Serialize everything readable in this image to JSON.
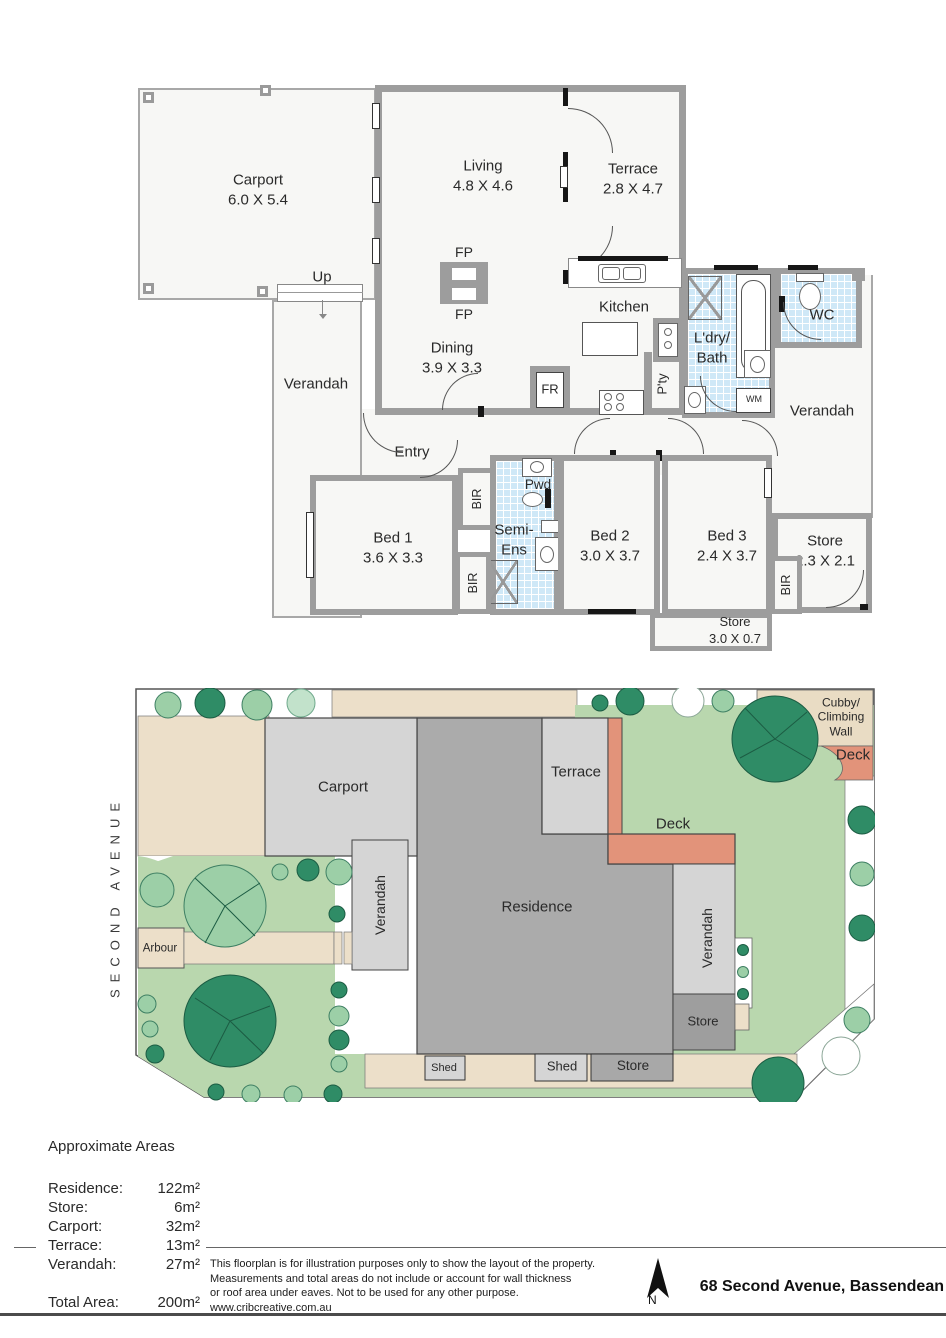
{
  "floorplan": {
    "rooms": {
      "carport": {
        "name": "Carport",
        "dims": "6.0 X 5.4"
      },
      "living": {
        "name": "Living",
        "dims": "4.8 X 4.6"
      },
      "terrace": {
        "name": "Terrace",
        "dims": "2.8 X 4.7"
      },
      "dining": {
        "name": "Dining",
        "dims": "3.9 X 3.3"
      },
      "kitchen": {
        "name": "Kitchen"
      },
      "bed1": {
        "name": "Bed 1",
        "dims": "3.6 X 3.3"
      },
      "bed2": {
        "name": "Bed 2",
        "dims": "3.0 X 3.7"
      },
      "bed3": {
        "name": "Bed 3",
        "dims": "2.4 X 3.7"
      },
      "store_right": {
        "name": "Store",
        "dims": "2.3 X 2.1"
      },
      "store_bottom": {
        "name": "Store",
        "dims": "3.0 X 0.7"
      },
      "laundry_bath": {
        "line1": "L'dry/",
        "line2": "Bath"
      },
      "semi_ens": {
        "line1": "Semi-",
        "line2": "Ens"
      },
      "wc": "WC",
      "pwd": "Pwd",
      "pantry": "P'ty",
      "fridge": "FR",
      "fireplace": "FP",
      "washing_machine": "WM",
      "bir": "BIR",
      "up": "Up",
      "entry": "Entry",
      "verandah": "Verandah"
    }
  },
  "siteplan": {
    "street": "SECOND AVENUE",
    "labels": {
      "carport": "Carport",
      "terrace": "Terrace",
      "deck": "Deck",
      "cubby_line1": "Cubby/",
      "cubby_line2": "Climbing",
      "cubby_line3": "Wall",
      "residence": "Residence",
      "verandah": "Verandah",
      "arbour": "Arbour",
      "store": "Store",
      "shed": "Shed",
      "store_small": "Store"
    }
  },
  "areas": {
    "title": "Approximate Areas",
    "rows": [
      {
        "label": "Residence:",
        "value": "122m²"
      },
      {
        "label": "Store:",
        "value": "6m²"
      },
      {
        "label": "Carport:",
        "value": "32m²"
      },
      {
        "label": "Terrace:",
        "value": "13m²"
      },
      {
        "label": "Verandah:",
        "value": "27m²"
      }
    ],
    "total": {
      "label": "Total Area:",
      "value": "200m²"
    }
  },
  "footer": {
    "disclaimer_line1": "This floorplan is for illustration purposes only to show the layout of the property.",
    "disclaimer_line2": "Measurements and total areas do not include or account for wall thickness",
    "disclaimer_line3": "or roof area under eaves. Not to be used for any other purpose.",
    "disclaimer_line4": "www.cribcreative.com.au",
    "north_label": "N",
    "address": "68 Second Avenue, Bassendean"
  },
  "colors": {
    "wall": "#9d9d9d",
    "tile": "#cfe8f7",
    "lawn": "#b9d7ae",
    "driveway": "#ecdfc9",
    "deck": "#e2937a",
    "cubby": "#e9dcc4",
    "building_light": "#d5d5d5",
    "residence": "#ababab",
    "store_dark": "#9e9e9e",
    "tree_dark": "#2f8c66",
    "tree_light": "#9ccfa7"
  }
}
